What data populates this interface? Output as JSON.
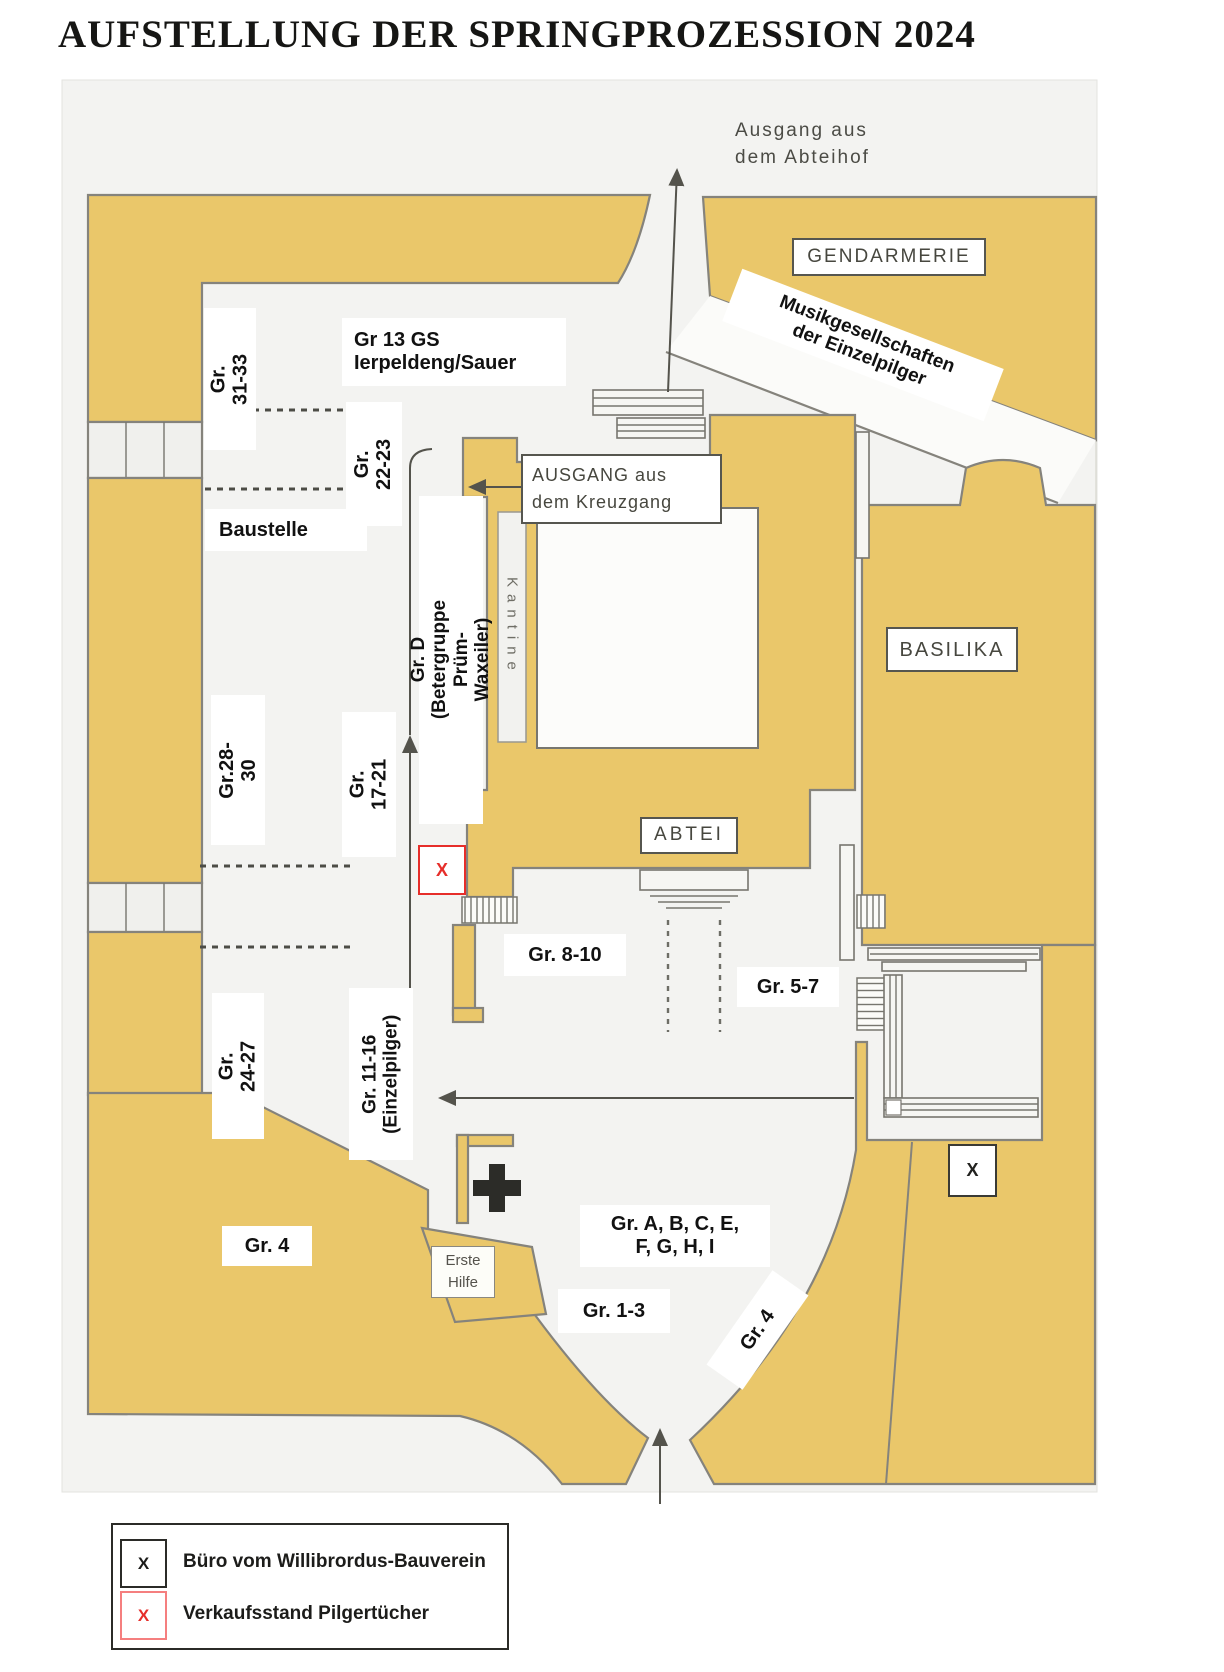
{
  "title": "AUFSTELLUNG DER SPRINGPROZESSION 2024",
  "colors": {
    "building": "#eac76a",
    "outline": "#85837c",
    "red": "#e62e2a",
    "map_bg": "#f3f3f1"
  },
  "map": {
    "labels": {
      "ausgang_abteihof": "Ausgang aus\ndem Abteihof",
      "gendarmerie": "GENDARMERIE",
      "musik": "Musikgesellschaften\nder Einzelpilger",
      "gr31": "Gr. 31-33",
      "gr13": "Gr 13 GS\nIerpeldeng/Sauer",
      "gr22": "Gr.\n22-23",
      "baustelle": "Baustelle",
      "ausgang_kreuzgang": "AUSGANG aus\ndem Kreuzgang",
      "kantine": "Kantine",
      "grd": "Gr. D\n(Betergruppe Prüm-Waxeiler)",
      "gr28": "Gr.28-30",
      "gr17": "Gr. 17-21",
      "abtei": "ABTEI",
      "basilika": "BASILIKA",
      "gr8": "Gr. 8-10",
      "gr5": "Gr. 5-7",
      "gr24": "Gr. 24-27",
      "gr11": "Gr. 11-16\n(Einzelpilger)",
      "erste_hilfe": "Erste\nHilfe",
      "gr4_left": "Gr. 4",
      "gr_letters": "Gr. A, B, C, E,\nF, G, H, I",
      "gr1": "Gr. 1-3",
      "gr4_right": "Gr. 4",
      "x_black": "X",
      "x_red": "X"
    }
  },
  "legend": {
    "items": [
      {
        "symbol": "X",
        "color": "black",
        "label": "Büro vom Willibrordus-Bauverein"
      },
      {
        "symbol": "X",
        "color": "red",
        "label": "Verkaufsstand Pilgertücher"
      }
    ]
  }
}
